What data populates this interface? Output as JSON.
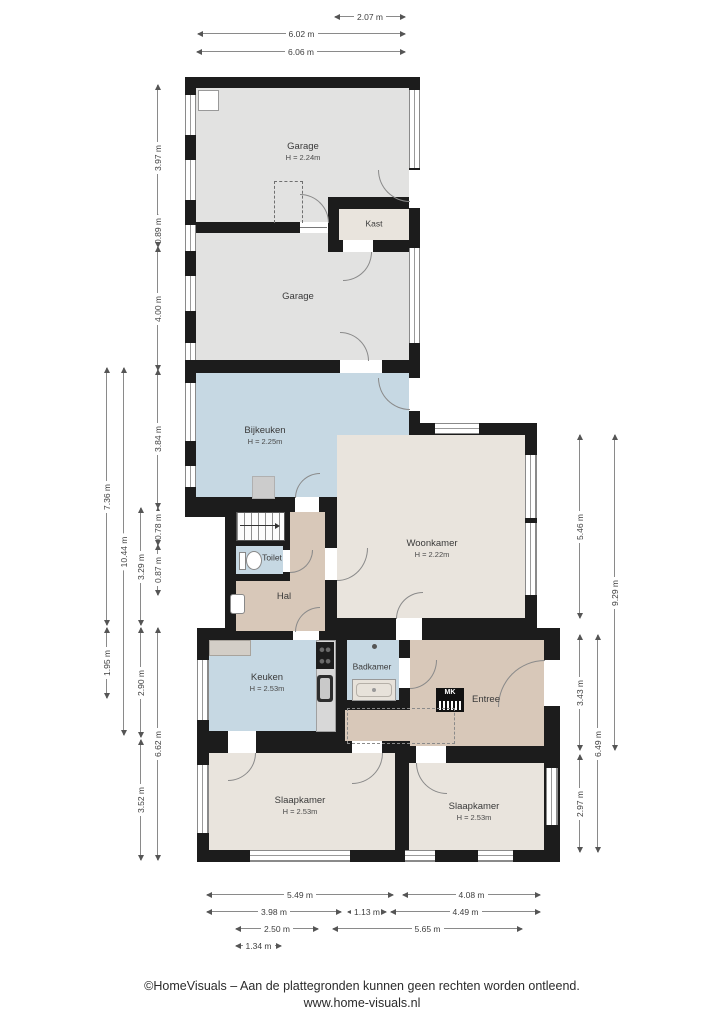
{
  "plan": {
    "rooms": {
      "garage_top": {
        "name": "Garage",
        "height": "H = 2.24m"
      },
      "kast": {
        "name": "Kast"
      },
      "garage_bottom": {
        "name": "Garage"
      },
      "bijkeuken": {
        "name": "Bijkeuken",
        "height": "H = 2.25m"
      },
      "toilet": {
        "name": "Toilet"
      },
      "hal": {
        "name": "Hal"
      },
      "woonkamer": {
        "name": "Woonkamer",
        "height": "H = 2.22m"
      },
      "keuken": {
        "name": "Keuken",
        "height": "H = 2.53m"
      },
      "badkamer": {
        "name": "Badkamer"
      },
      "entree": {
        "name": "Entree"
      },
      "slaapkamer_left": {
        "name": "Slaapkamer",
        "height": "H = 2.53m"
      },
      "slaapkamer_right": {
        "name": "Slaapkamer",
        "height": "H = 2.53m"
      }
    },
    "labels": {
      "meterkast": "MK"
    },
    "colors": {
      "wall": "#1c1c1c",
      "floor_garage": "#e2e2e1",
      "floor_wet_rooms": "#c6d8e3",
      "floor_hall": "#d8c8b9",
      "floor_living": "#e9e4dd"
    }
  },
  "dimensions": {
    "top": [
      "2.07 m",
      "6.02 m",
      "6.06 m"
    ],
    "left": [
      "3.97 m",
      "0.89 m",
      "4.00 m",
      "3.84 m",
      "0.78 m",
      "0.87 m",
      "6.62 m",
      "3.29 m",
      "2.90 m",
      "3.52 m",
      "10.44 m",
      "7.36 m",
      "1.95 m"
    ],
    "right": [
      "5.46 m",
      "3.43 m",
      "2.97 m",
      "6.49 m",
      "9.29 m"
    ],
    "bottom": [
      "5.49 m",
      "4.08 m",
      "3.98 m",
      "1.13 m",
      "4.49 m",
      "2.50 m",
      "5.65 m",
      "1.34 m"
    ]
  },
  "footer": {
    "line1": "©HomeVisuals – Aan de plattegronden kunnen geen rechten worden ontleend.",
    "line2": "www.home-visuals.nl"
  }
}
